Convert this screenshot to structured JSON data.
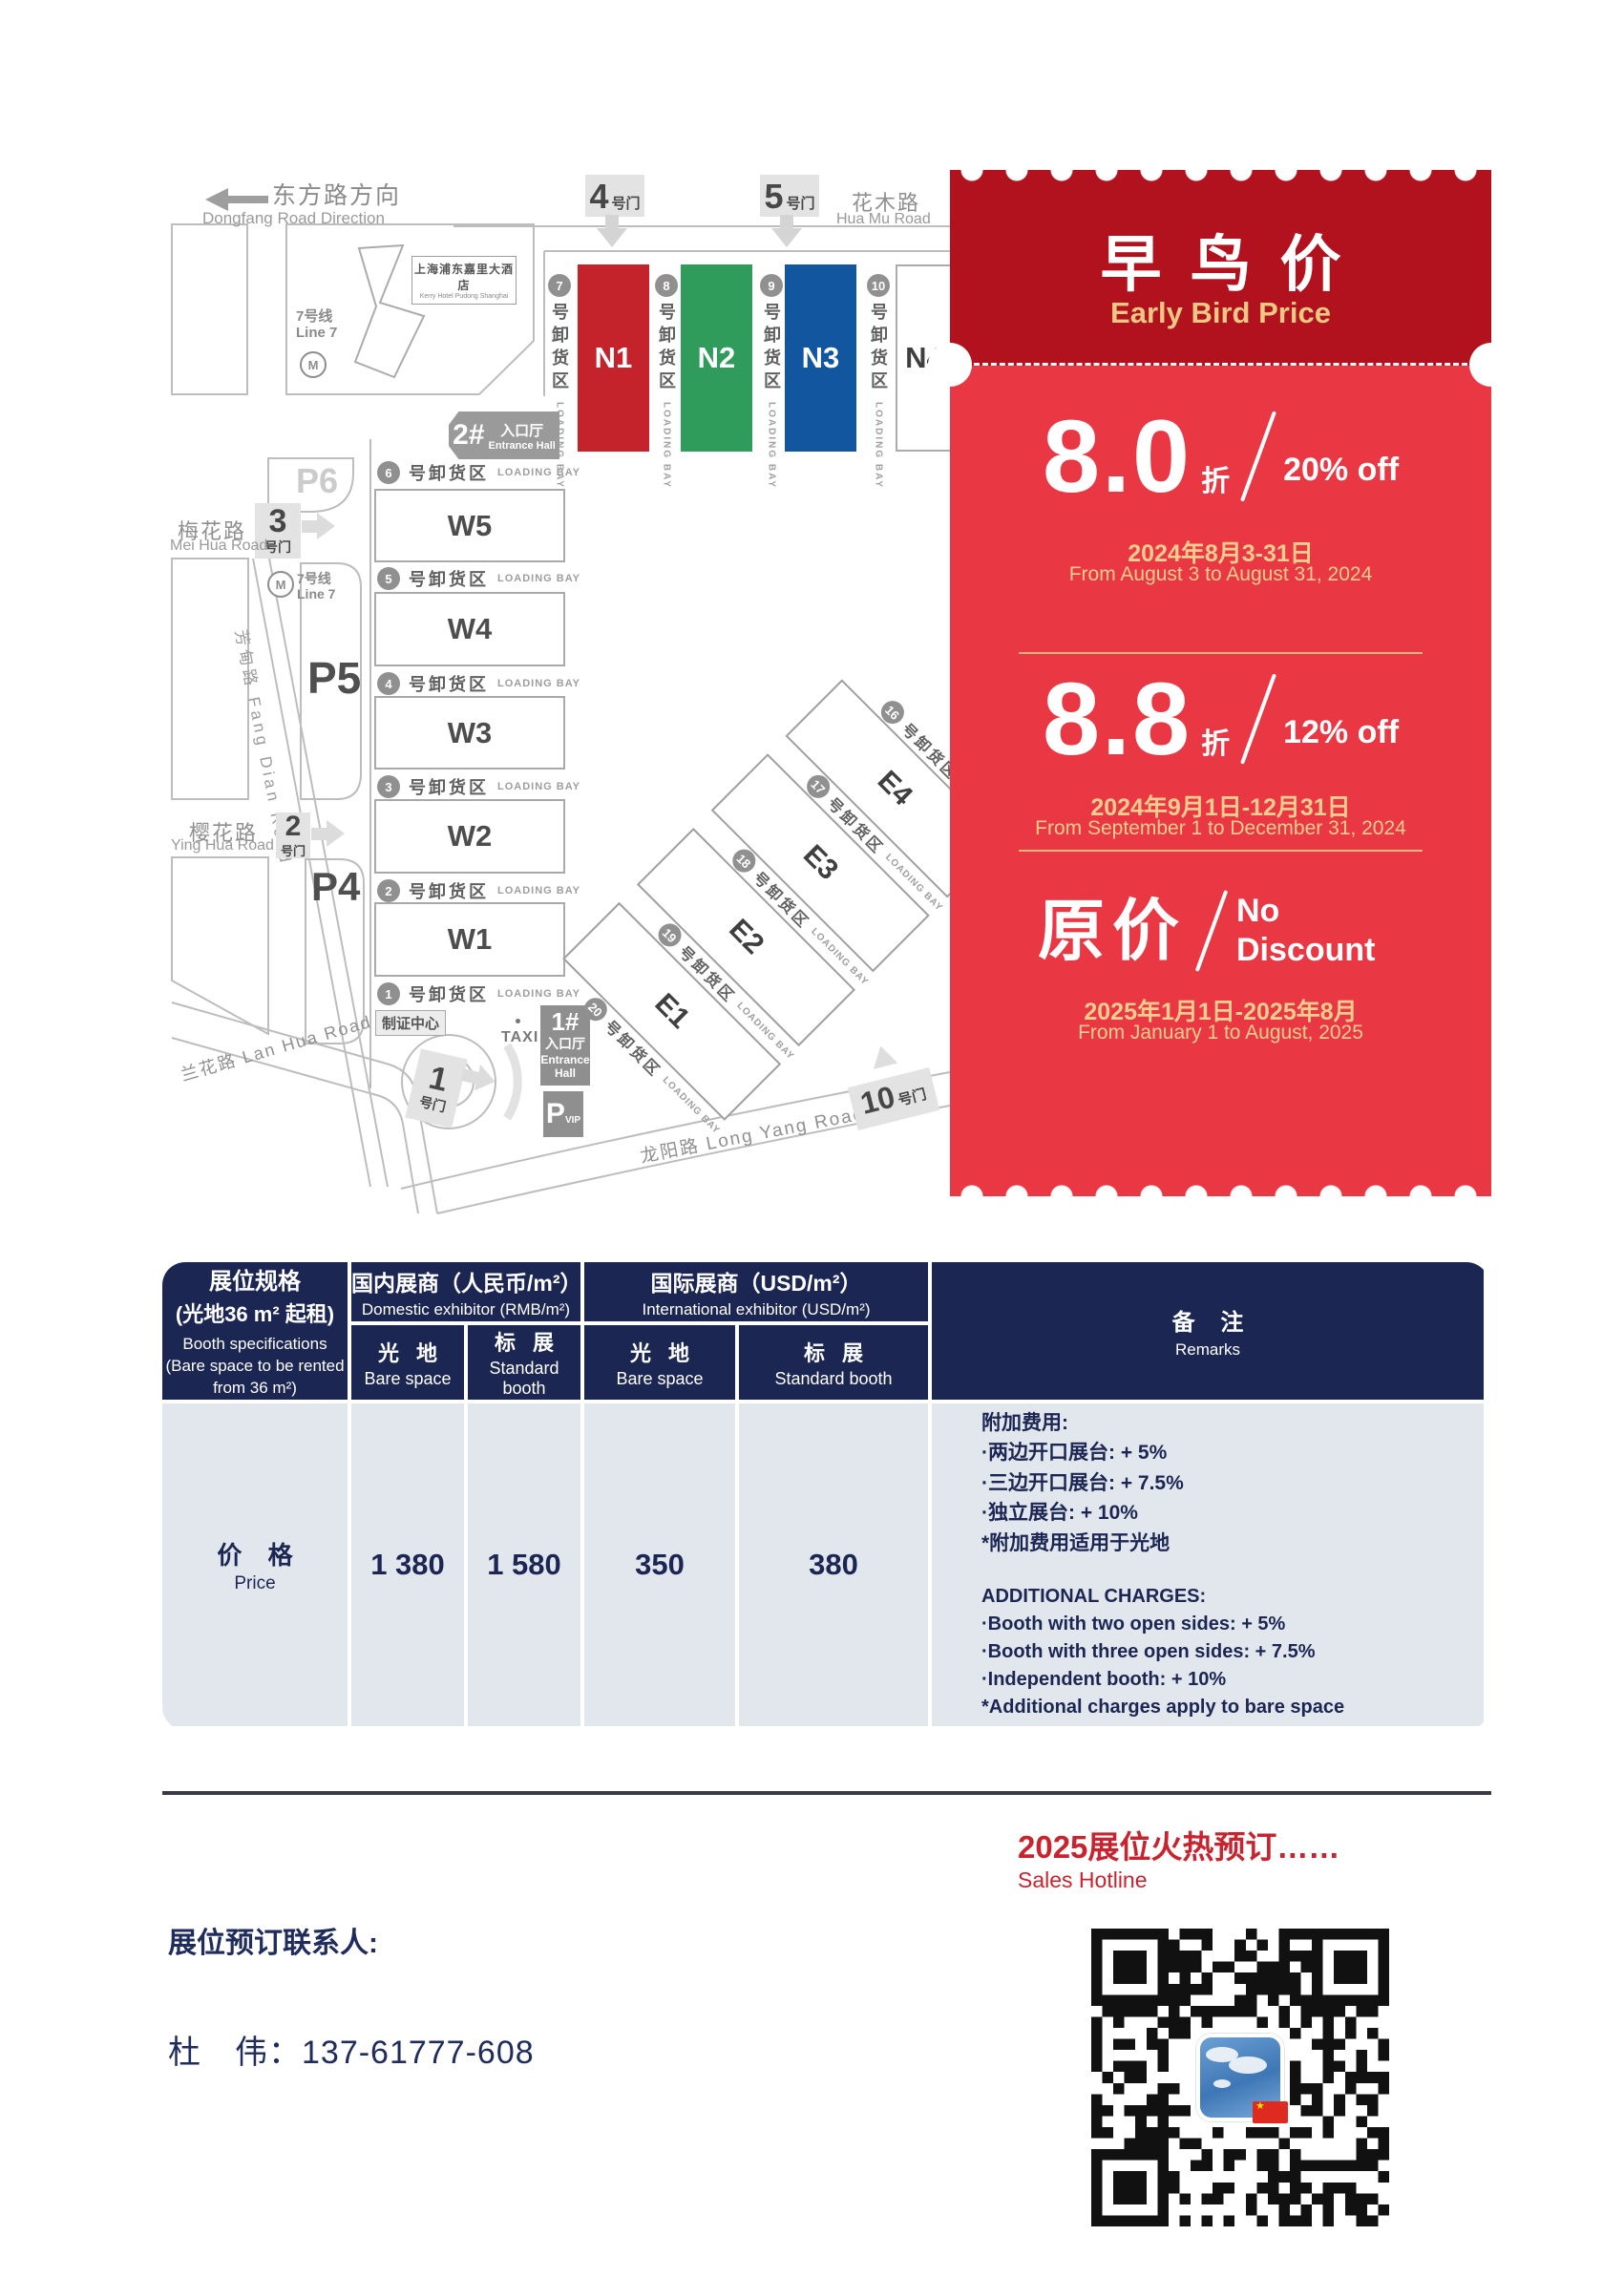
{
  "colors": {
    "coupon_dark_red": "#b1121d",
    "coupon_red": "#e93843",
    "coupon_gold": "#ecc884",
    "table_navy": "#1c2653",
    "table_body_bg": "#e2e7ee",
    "hall_n1_red": "#c4232b",
    "hall_n2_green": "#2f9c5c",
    "hall_n3_blue": "#11569f",
    "footer_red": "#c8232e"
  },
  "map": {
    "direction_cn": "东方路方向",
    "direction_en": "Dongfang Road Direction",
    "huamu_cn": "花木路",
    "huamu_en": "Hua Mu Road",
    "meihua_cn": "梅花路",
    "meihua_en": "Mei Hua Road",
    "yinghua_cn": "樱花路",
    "yinghua_en": "Ying Hua Road",
    "lanhua": "兰花路 Lan Hua Road",
    "fangdian": "芳甸路 Fang Dian Road",
    "longyang": "龙阳路  Long Yang Road",
    "metro_cn": "7号线",
    "metro_en": "Line 7",
    "metro_m": "M",
    "hotel_cn": "上海浦东嘉里大酒店",
    "hotel_en": "Kerry Hotel Pudong Shanghai",
    "gate_suffix": "号门",
    "gates": {
      "g1": "1",
      "g2": "2",
      "g3": "3",
      "g4": "4",
      "g5": "5",
      "g10": "10"
    },
    "entrance1_num": "1#",
    "entrance2_num": "2#",
    "entrance_cn": "入口厅",
    "entrance_en": "Entrance Hall",
    "entrance_en1": "Entrance",
    "entrance_en2": "Hall",
    "badge_center": "制证中心",
    "taxi": "TAXI",
    "p4": "P4",
    "p5": "P5",
    "p6": "P6",
    "pvip_p": "P",
    "pvip_sub": "VIP",
    "bay_cn": "号卸货区",
    "bay_en": "LOADING BAY",
    "n_bays": [
      "7",
      "8",
      "9",
      "10"
    ],
    "n_halls": [
      "N1",
      "N2",
      "N3",
      "N4"
    ],
    "w_bays": [
      "6",
      "5",
      "4",
      "3",
      "2",
      "1"
    ],
    "w_halls": [
      "W5",
      "W4",
      "W3",
      "W2",
      "W1"
    ],
    "e_bays": [
      "16",
      "17",
      "18",
      "19",
      "20"
    ],
    "e_halls": [
      "E4",
      "E3",
      "E2",
      "E1"
    ]
  },
  "coupon": {
    "title_cn": "早鸟价",
    "title_en": "Early Bird Price",
    "tiers": [
      {
        "big": "8.0",
        "unit": "折",
        "off": "20% off",
        "date_cn": "2024年8月3-31日",
        "date_en": "From August 3 to August 31, 2024"
      },
      {
        "big": "8.8",
        "unit": "折",
        "off": "12% off",
        "date_cn": "2024年9月1日-12月31日",
        "date_en": "From September 1 to December 31, 2024"
      },
      {
        "big": "原价",
        "unit": "",
        "off": "No Discount",
        "date_cn": "2025年1月1日-2025年8月",
        "date_en": "From January 1 to August, 2025"
      }
    ]
  },
  "table": {
    "spec_cn1": "展位规格",
    "spec_cn2": "(光地36 m² 起租)",
    "spec_en1": "Booth specifications",
    "spec_en2": "(Bare space to be rented",
    "spec_en3": "from 36 m²)",
    "domestic_cn": "国内展商（人民币/m²）",
    "domestic_en": "Domestic exhibitor (RMB/m²)",
    "intl_cn": "国际展商（USD/m²）",
    "intl_en": "International exhibitor (USD/m²)",
    "bare_cn": "光 地",
    "bare_en": "Bare space",
    "std_cn": "标 展",
    "std_en": "Standard booth",
    "remarks_cn_head": "备 注",
    "remarks_en_head": "Remarks",
    "row_label_cn": "价 格",
    "row_label_en": "Price",
    "values": [
      "1 380",
      "1 580",
      "350",
      "380"
    ],
    "remarks_cn": [
      "附加费用:",
      "·两边开口展台: + 5%",
      "·三边开口展台: + 7.5%",
      "·独立展台: + 10%",
      "*附加费用适用于光地"
    ],
    "remarks_en": [
      "ADDITIONAL CHARGES:",
      "·Booth with two open sides: + 5%",
      "·Booth with three open sides: + 7.5%",
      "·Independent booth: + 10%",
      "*Additional charges apply to bare space"
    ]
  },
  "footer": {
    "hotline_cn": "2025展位火热预订……",
    "hotline_en": "Sales Hotline",
    "contact_label": "展位预订联系人:",
    "contact_phone": "杜　伟：137-61777-608"
  }
}
